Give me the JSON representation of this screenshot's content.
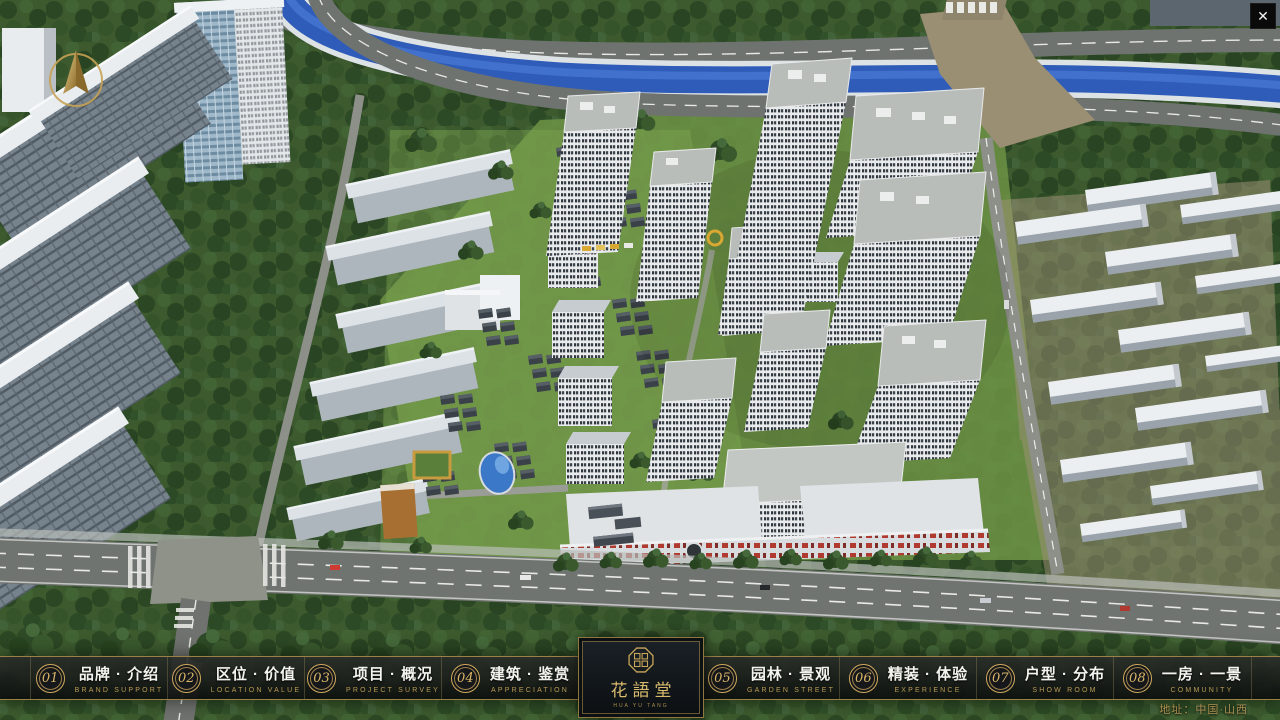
{
  "window": {
    "close_glyph": "✕"
  },
  "theme": {
    "accent_gold": "#c9a659",
    "bar_bg": "#14161a",
    "text_white": "#f4f4ef"
  },
  "logo": {
    "title": "花語堂",
    "subtitle": "HUA YU TANG"
  },
  "menu": {
    "items": [
      {
        "num": "01",
        "label": "品牌 · 介绍",
        "sub": "BRAND SUPPORT"
      },
      {
        "num": "02",
        "label": "区位 · 价值",
        "sub": "LOCATION VALUE"
      },
      {
        "num": "03",
        "label": "项目 · 概况",
        "sub": "PROJECT SURVEY"
      },
      {
        "num": "04",
        "label": "建筑 · 鉴赏",
        "sub": "APPRECIATION"
      },
      {
        "num": "05",
        "label": "园林 · 景观",
        "sub": "GARDEN STREET"
      },
      {
        "num": "06",
        "label": "精装 · 体验",
        "sub": "EXPERIENCE"
      },
      {
        "num": "07",
        "label": "户型 · 分布",
        "sub": "SHOW ROOM"
      },
      {
        "num": "08",
        "label": "一房 · 一景",
        "sub": "COMMUNITY"
      }
    ]
  },
  "footer": {
    "address": "地址：中国·山西"
  }
}
